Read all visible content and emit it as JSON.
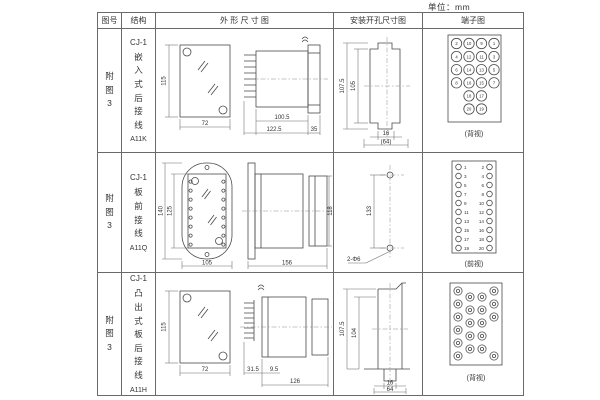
{
  "unit_label": "单位：mm",
  "table": {
    "headers": [
      "图号",
      "结构",
      "外 形 尺 寸 图",
      "安装开孔尺寸图",
      "端子图"
    ],
    "rows": [
      {
        "fig_no": "附图3",
        "series": "CJ-1",
        "structure": "嵌入式后接线",
        "model": "A11K",
        "outline": {
          "front_height": "115",
          "front_width": "72",
          "body_depth": "100.5",
          "overall_depth": "122.5",
          "flange_depth": "35"
        },
        "mounting": {
          "v_outer": "107.5",
          "v_inner": "105",
          "h_slot": "16",
          "h_overall": "(64)"
        },
        "terminal": {
          "caption": "(背视)",
          "rows": [
            [
              "2",
              "10",
              "9",
              "1"
            ],
            [
              "4",
              "12",
              "11",
              "3"
            ],
            [
              "6",
              "14",
              "13",
              "5"
            ],
            [
              "8",
              "16",
              "15",
              "7"
            ],
            [
              "18",
              "17"
            ],
            [
              "20",
              "19"
            ]
          ]
        }
      },
      {
        "fig_no": "附图3",
        "series": "CJ-1",
        "structure": "板前接线",
        "model": "A11Q",
        "outline": {
          "front_height": "140",
          "inner_height": "125",
          "front_width": "105",
          "body_depth": "156",
          "side_height": "118"
        },
        "mounting": {
          "hole_spacing": "133",
          "holes_label": "2-Φ6"
        },
        "terminal": {
          "caption": "(前视)",
          "left": [
            "1",
            "3",
            "5",
            "7",
            "9",
            "11",
            "13",
            "15",
            "17",
            "19"
          ],
          "right": [
            "2",
            "4",
            "6",
            "8",
            "10",
            "12",
            "14",
            "16",
            "18",
            "20"
          ]
        }
      },
      {
        "fig_no": "附图3",
        "series": "CJ-1",
        "structure": "凸出式板后接线",
        "model": "A11H",
        "outline": {
          "front_height": "115",
          "front_width": "72",
          "pin_depth": "31.5",
          "gap": "9.5",
          "body_depth": "126"
        },
        "mounting": {
          "v_outer": "107.5",
          "v_inner": "104",
          "h_slot": "16",
          "h_overall": "64"
        },
        "terminal": {
          "caption": "(背视)"
        }
      }
    ]
  }
}
